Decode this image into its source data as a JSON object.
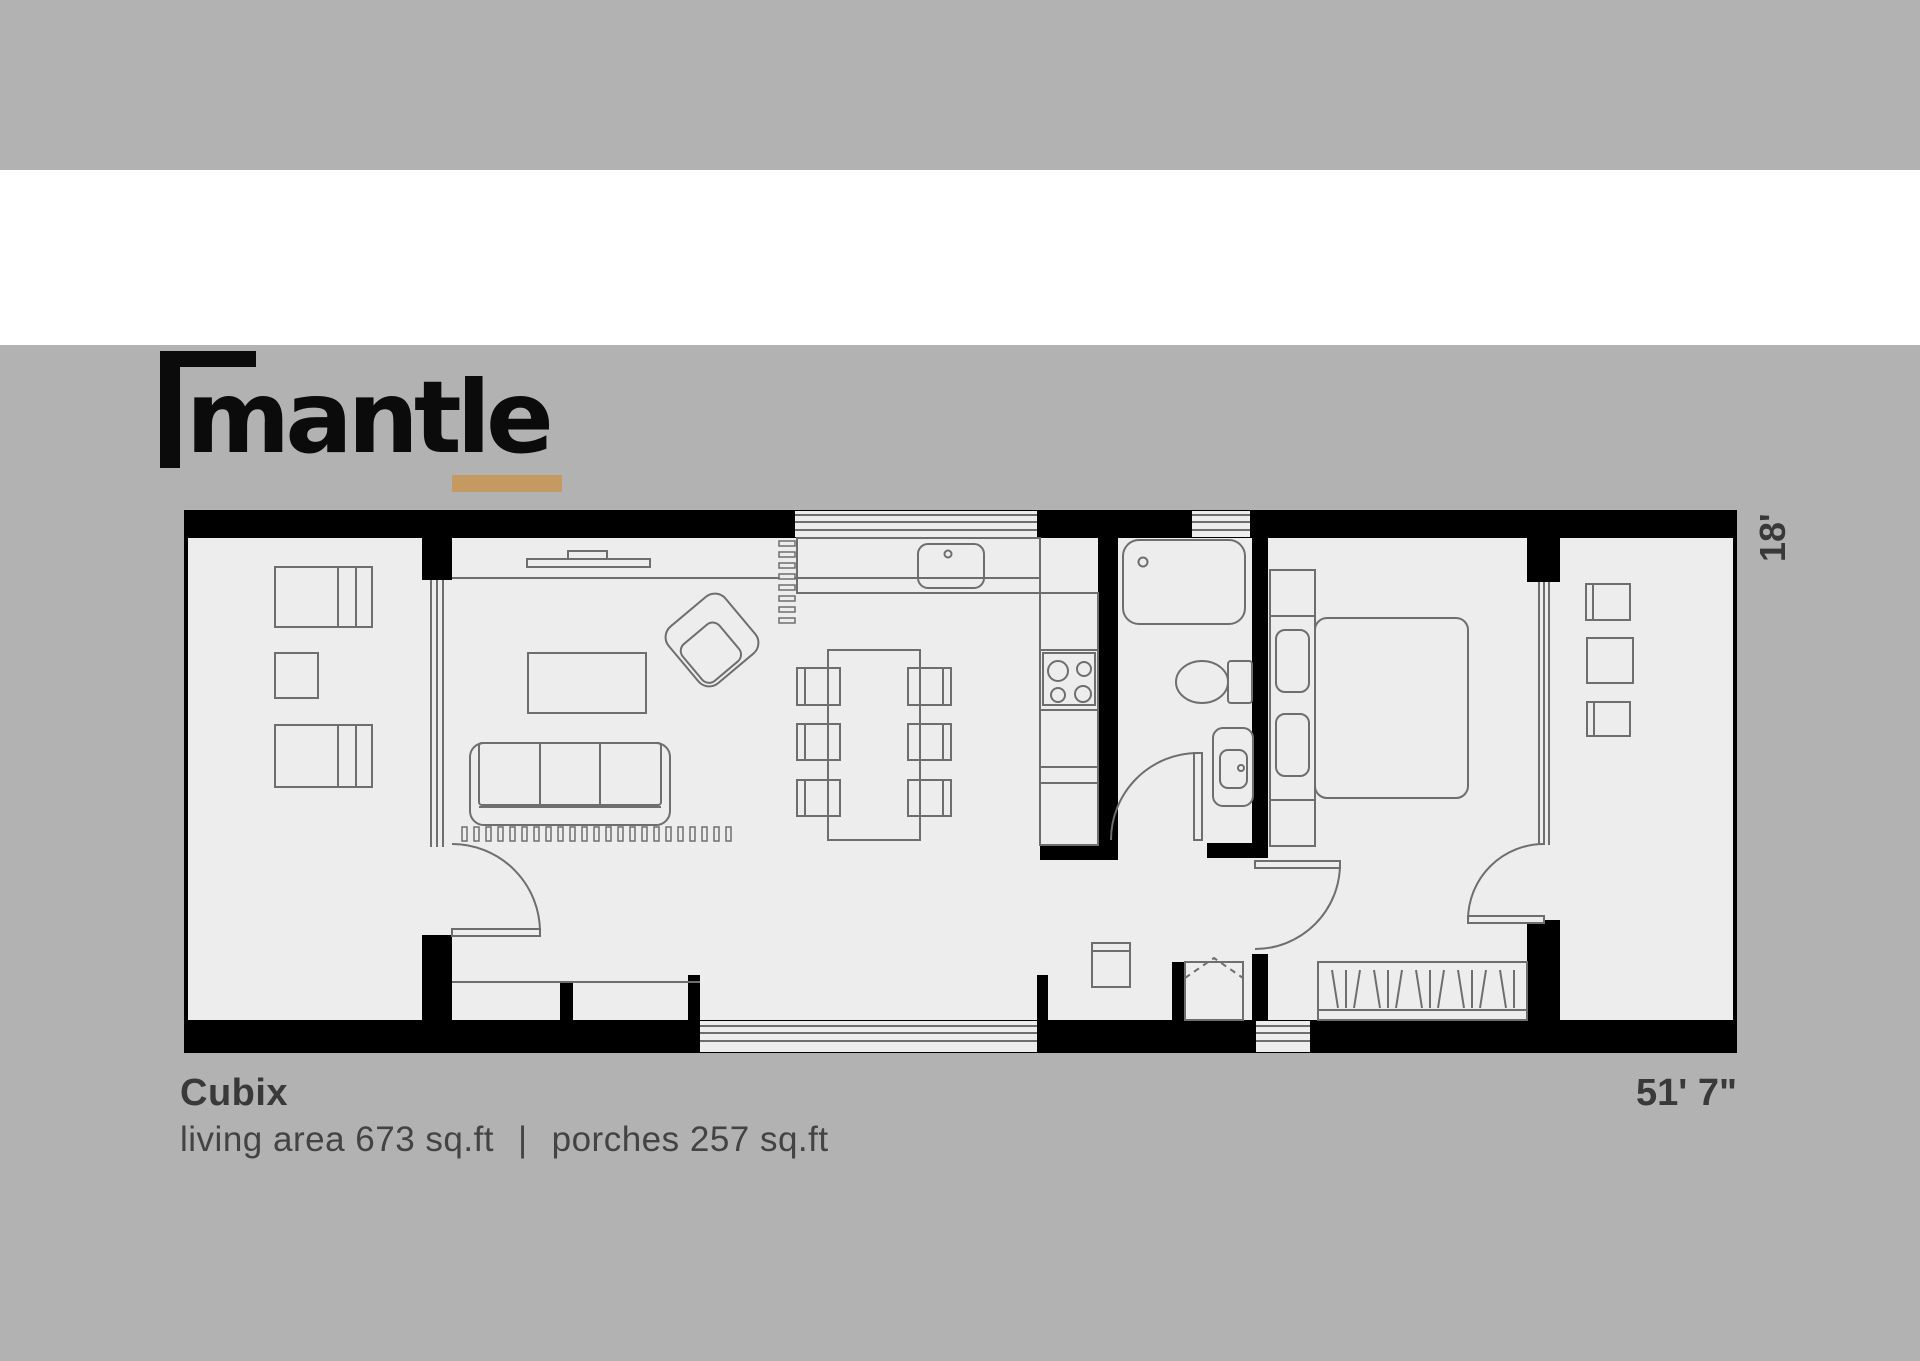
{
  "logo": {
    "wordmark": "mantle"
  },
  "floorplan": {
    "title": "Cubix",
    "caption": {
      "living": "living area 673 sq.ft",
      "separator": "|",
      "porches": "porches 257 sq.ft"
    },
    "dimensions": {
      "width": "51' 7\"",
      "height": "18'"
    },
    "living_area_sqft": 673,
    "porches_sqft": 257
  },
  "colors": {
    "canvas_gray": "#b2b2b2",
    "band_white": "#ffffff",
    "accent_gold": "#c59a62",
    "wall_black": "#000000",
    "floor_light": "#ededed",
    "line_gray": "#6e6e6e",
    "text_dark": "#393939"
  }
}
